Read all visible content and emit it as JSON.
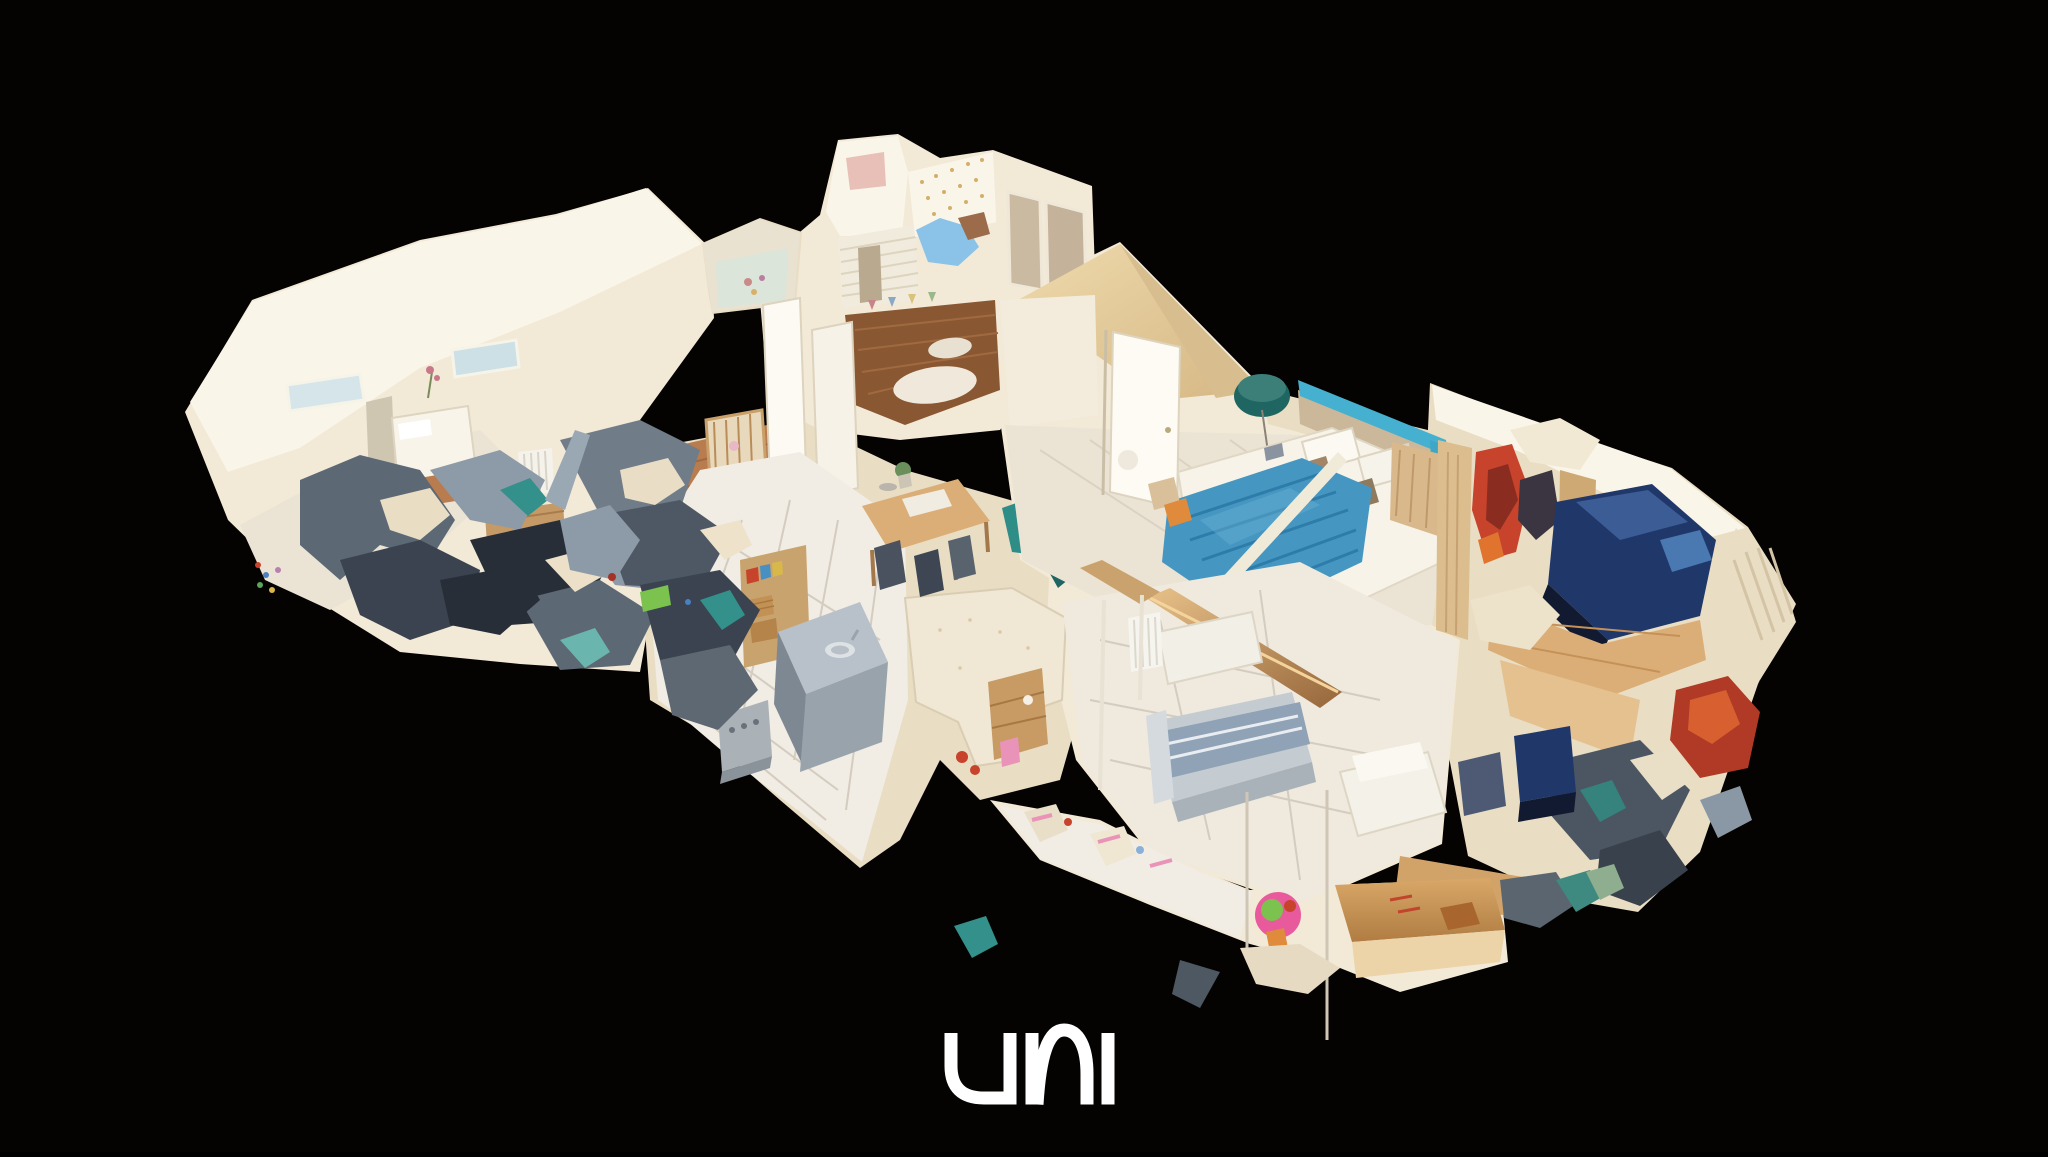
{
  "logo": {
    "text": "uni",
    "color": "#ffffff"
  },
  "canvas": {
    "background": "#050302"
  },
  "palette": {
    "bg": "#050302",
    "creamBright": "#faf5e9",
    "creamBase": "#f2e9d7",
    "creamShade": "#e9ddc3",
    "creamDim": "#dccdae",
    "tanRoof": "#e7d1a5",
    "tanDeep": "#d8bd8e",
    "buff": "#c9a97a",
    "woodDark": "#8a5733",
    "woodMid": "#b97c4e",
    "woodLight": "#dcae77",
    "woodPale": "#ecd3a8",
    "floorPale": "#ebe4d5",
    "tilePale": "#f1ece4",
    "tileLine": "#d3ccbf",
    "slate": "#5d6875",
    "slateDark": "#3a434f",
    "slateDeep": "#272e38",
    "steel": "#8d9aa7",
    "steelLight": "#b8c1c9",
    "teal": "#33908a",
    "tealDark": "#1f6663",
    "tealLight": "#6ab5ad",
    "blueBlanket": "#4597c1",
    "blueDeep": "#2e7ca9",
    "blueSky": "#8ac2e8",
    "blueHead": "#45b0cf",
    "navy": "#20376a",
    "navyDark": "#111a30",
    "red": "#c7432c",
    "redDark": "#8a2d20",
    "orange": "#e08a3c",
    "pink": "#ea93b8",
    "pinkDeep": "#e85a9c",
    "green": "#7bc24f",
    "white": "#ffffff"
  }
}
